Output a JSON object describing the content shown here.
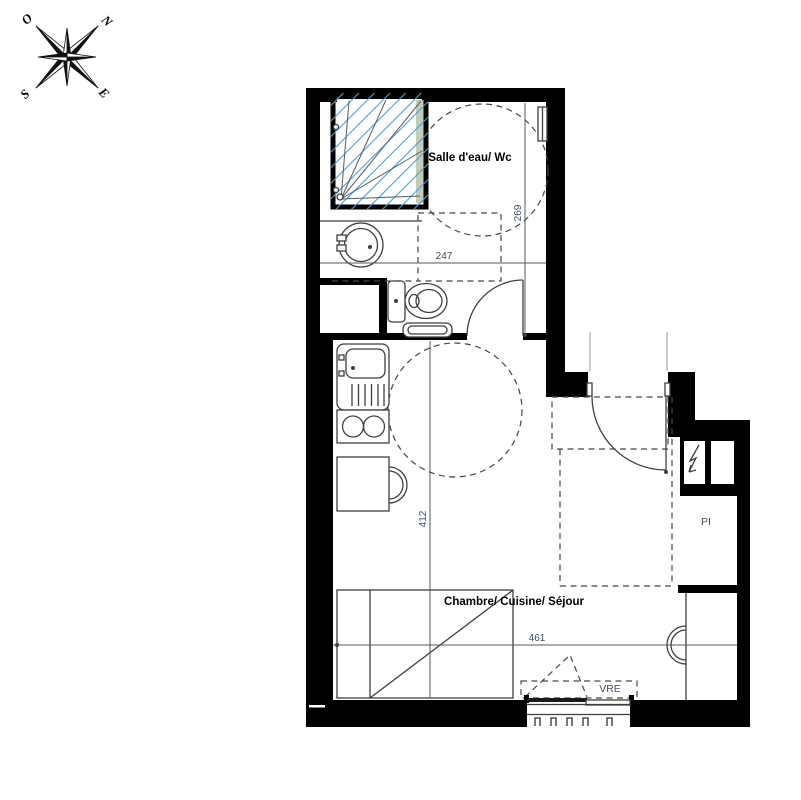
{
  "plan_title": "Studio floor plan",
  "compass": {
    "points": [
      {
        "dir": "north",
        "label": "N"
      },
      {
        "dir": "west",
        "label": "O"
      },
      {
        "dir": "south",
        "label": "S"
      },
      {
        "dir": "east",
        "label": "E"
      }
    ]
  },
  "rooms": [
    {
      "name": "Salle d'eau/ Wc"
    },
    {
      "name": "Chambre/ Cuisine/ Séjour"
    }
  ],
  "annotations": {
    "closet": "PI",
    "shutter": "VRE"
  },
  "dimensions": {
    "bathroom_width": "247",
    "bathroom_depth": "269",
    "main_depth": "412",
    "main_width": "461"
  },
  "colors": {
    "wall": "#000000",
    "line": "#3f3f3f",
    "thin": "#9a9a9a",
    "dash": "#474747",
    "dimline": "#5a5a5a",
    "hatch": "#4d9fd6",
    "dim-text": "#3d4f66",
    "room-text": "#000000",
    "glass": "#c2cdb8"
  }
}
